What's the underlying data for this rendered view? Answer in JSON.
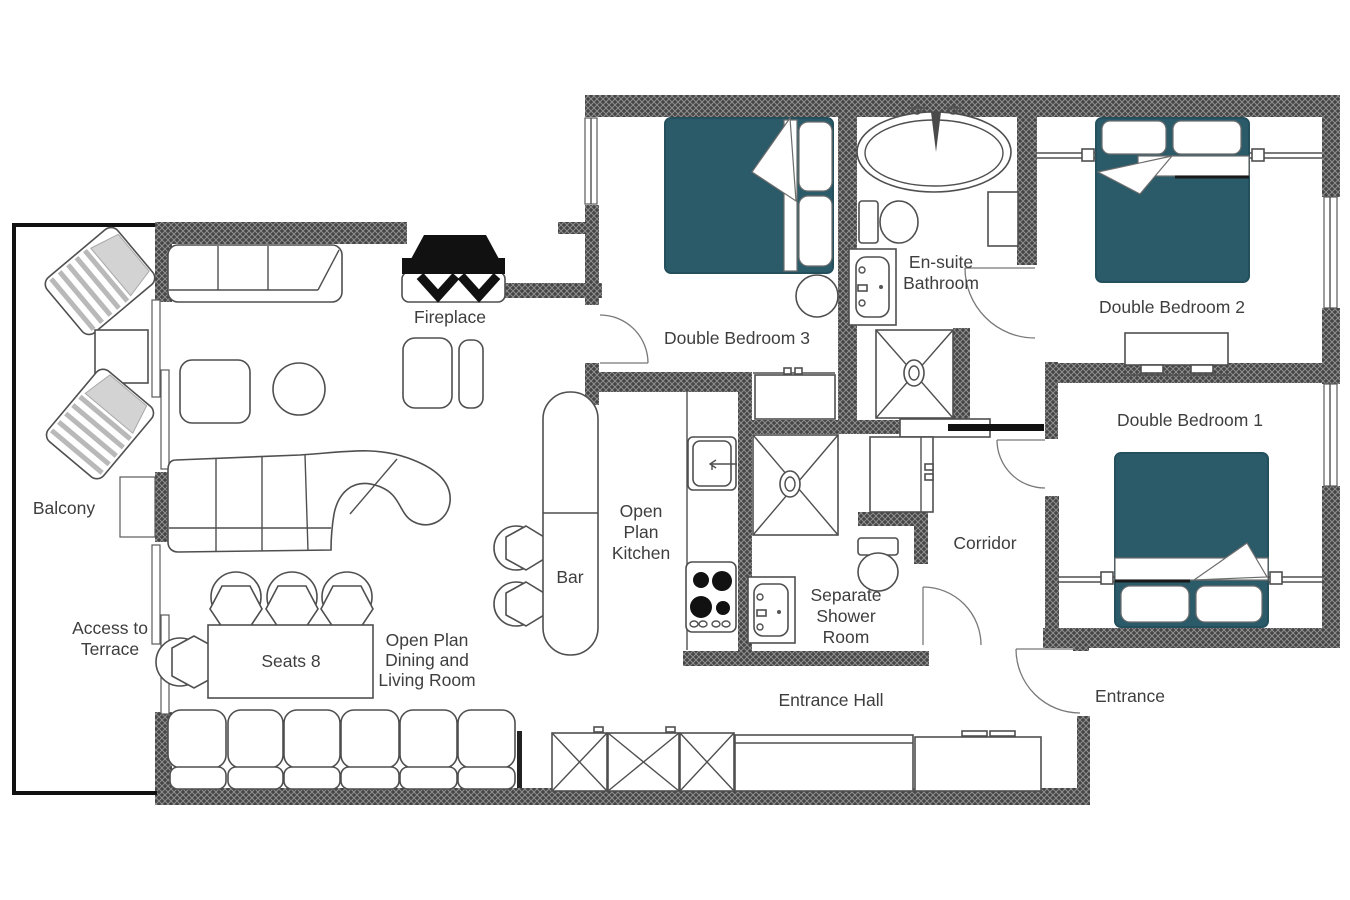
{
  "title": "Apartment Floor Plan",
  "colors": {
    "bed_teal": "#2b5a69",
    "wall_dark": "#454545",
    "line": "#4f4f4f",
    "text": "#3e3e3e",
    "black": "#111111"
  },
  "rooms": {
    "balcony": {
      "label": "Balcony"
    },
    "terrace_access": {
      "lines": [
        "Access to",
        "Terrace"
      ]
    },
    "living": {
      "lines": [
        "Open Plan",
        "Dining and",
        "Living Room"
      ]
    },
    "dining_table": {
      "label": "Seats 8"
    },
    "bar": {
      "label": "Bar"
    },
    "kitchen": {
      "lines": [
        "Open",
        "Plan",
        "Kitchen"
      ]
    },
    "fireplace": {
      "label": "Fireplace"
    },
    "bedroom3": {
      "label": "Double Bedroom 3"
    },
    "ensuite": {
      "lines": [
        "En-suite",
        "Bathroom"
      ]
    },
    "bedroom2": {
      "label": "Double Bedroom 2"
    },
    "bedroom1": {
      "label": "Double Bedroom 1"
    },
    "corridor": {
      "label": "Corridor"
    },
    "shower_room": {
      "lines": [
        "Separate",
        "Shower",
        "Room"
      ]
    },
    "entrance_hall": {
      "label": "Entrance Hall"
    },
    "entrance": {
      "label": "Entrance"
    }
  }
}
